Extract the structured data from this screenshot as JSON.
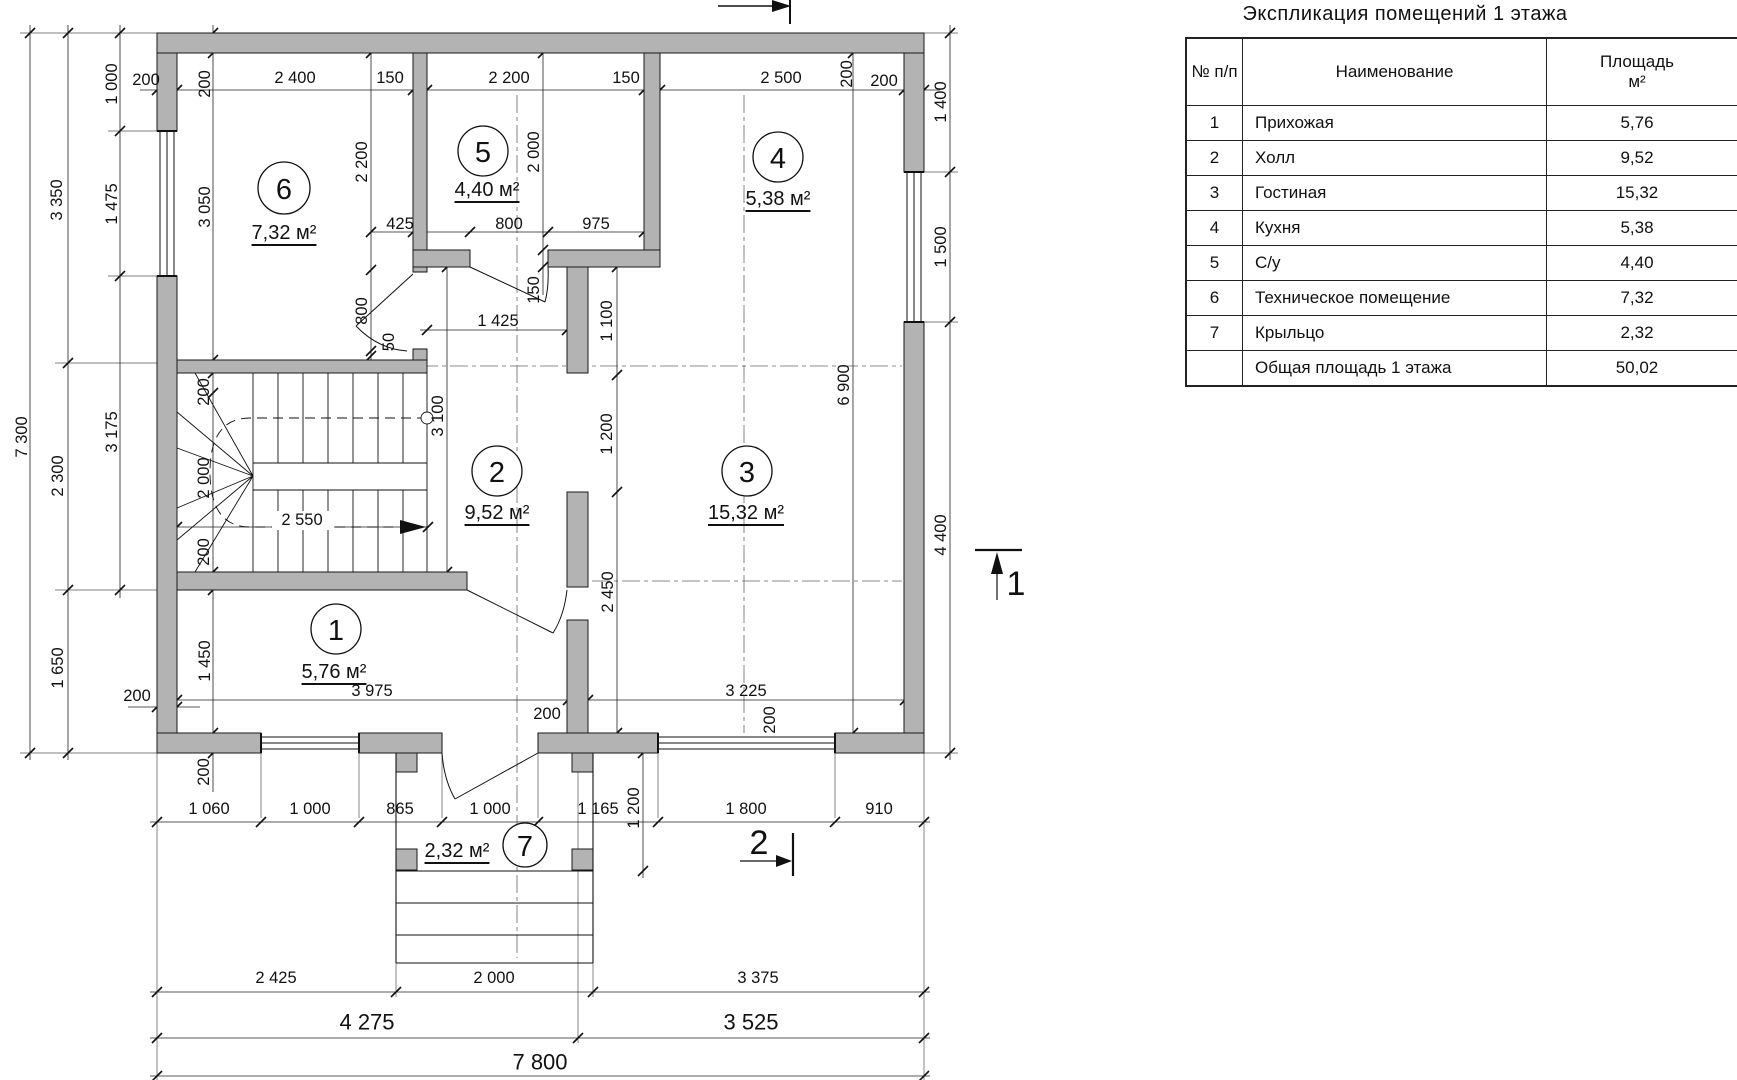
{
  "table": {
    "title": "Экспликация помещений 1 этажа",
    "headers": {
      "num": "№ п/п",
      "name": "Наименование",
      "area_line1": "Площадь",
      "area_line2": "м²"
    },
    "rows": [
      {
        "num": "1",
        "name": "Прихожая",
        "area": "5,76"
      },
      {
        "num": "2",
        "name": "Холл",
        "area": "9,52"
      },
      {
        "num": "3",
        "name": "Гостиная",
        "area": "15,32"
      },
      {
        "num": "4",
        "name": "Кухня",
        "area": "5,38"
      },
      {
        "num": "5",
        "name": "С/у",
        "area": "4,40"
      },
      {
        "num": "6",
        "name": "Техническое помещение",
        "area": "7,32"
      },
      {
        "num": "7",
        "name": "Крыльцо",
        "area": "2,32"
      },
      {
        "num": "",
        "name": "Общая площадь 1 этажа",
        "area": "50,02"
      }
    ]
  },
  "rooms": {
    "r1": {
      "num": "1",
      "area": "5,76 м²"
    },
    "r2": {
      "num": "2",
      "area": "9,52 м²"
    },
    "r3": {
      "num": "3",
      "area": "15,32 м²"
    },
    "r4": {
      "num": "4",
      "area": "5,38 м²"
    },
    "r5": {
      "num": "5",
      "area": "4,40 м²"
    },
    "r6": {
      "num": "6",
      "area": "7,32 м²"
    },
    "r7": {
      "num": "7",
      "area": "2,32 м²"
    }
  },
  "dims": {
    "d50": "50",
    "d150": "150",
    "d200": "200",
    "d425": "425",
    "d800": "800",
    "d865": "865",
    "d910": "910",
    "d975": "975",
    "d1000": "1 000",
    "d1060": "1 060",
    "d1100": "1 100",
    "d1165": "1 165",
    "d1200": "1 200",
    "d1400": "1 400",
    "d1425": "1 425",
    "d1450": "1 450",
    "d1475": "1 475",
    "d1500": "1 500",
    "d1650": "1 650",
    "d1800": "1 800",
    "d2000": "2 000",
    "d2200": "2 200",
    "d2300": "2 300",
    "d2400": "2 400",
    "d2425": "2 425",
    "d2450": "2 450",
    "d2500": "2 500",
    "d2550": "2 550",
    "d3050": "3 050",
    "d3100": "3 100",
    "d3175": "3 175",
    "d3225": "3 225",
    "d3350": "3 350",
    "d3375": "3 375",
    "d3525": "3 525",
    "d3975": "3 975",
    "d4275": "4 275",
    "d4400": "4 400",
    "d6900": "6 900",
    "d7300": "7 300",
    "d7800": "7 800"
  },
  "sections": {
    "s1": "1",
    "s2": "2"
  }
}
